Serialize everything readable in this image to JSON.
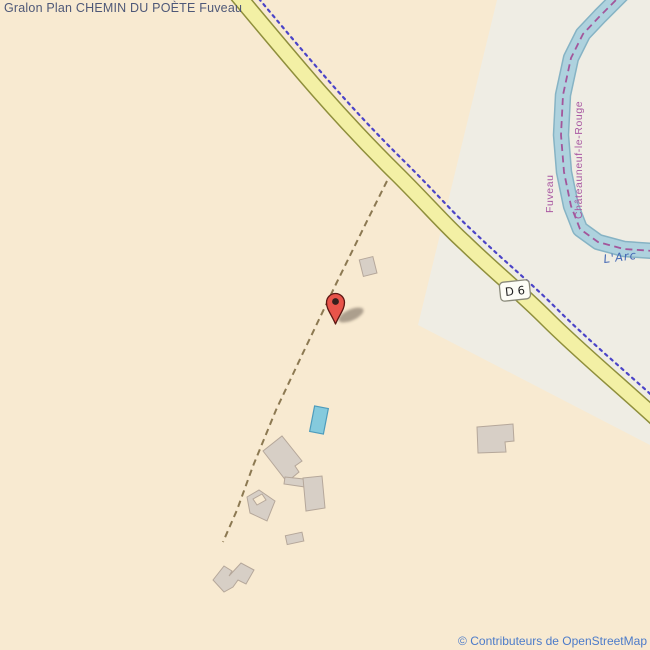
{
  "page": {
    "title": "Gralon Plan CHEMIN DU POÈTE Fuveau"
  },
  "map": {
    "road_ref": "D 6",
    "river_name": "L'Arc",
    "boundary_commune_left": "Fuveau",
    "boundary_commune_right": "Châteauneuf-le-Rouge"
  },
  "attribution": "© Contributeurs de OpenStreetMap",
  "colors": {
    "land": "#f8ead1",
    "residential_area": "#efede4",
    "road_fill": "#f3f0a5",
    "road_casing": "#8f8f3c",
    "river_fill": "#aed2de",
    "river_casing": "#86b3c4",
    "admin_boundary_purple": "#a3569b",
    "admin_boundary_blue": "#4b44c8",
    "track_dash": "#8c7952",
    "building": "#d7cfc6",
    "pool": "#85cadd",
    "marker_red": "#e8544a",
    "title_text": "#4e5878",
    "attribution_text": "#4c7bc9"
  }
}
